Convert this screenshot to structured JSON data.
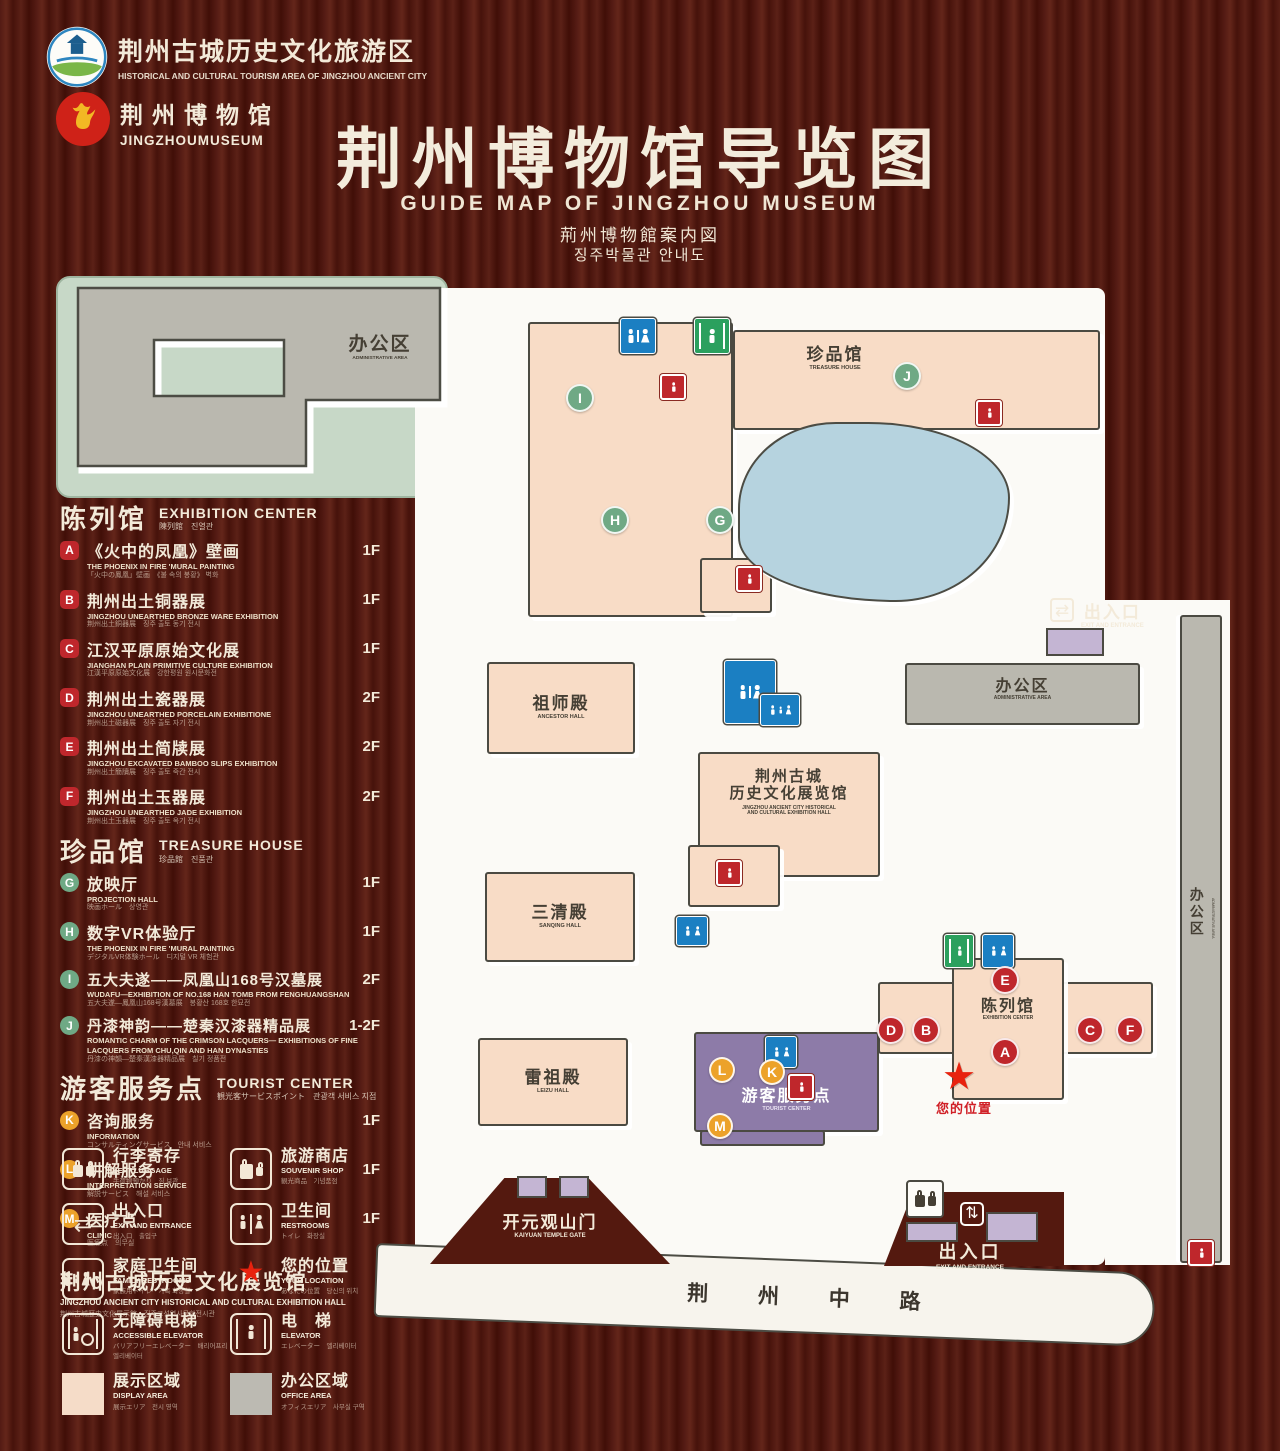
{
  "header": {
    "logo1": {
      "title": "荆州古城历史文化旅游区",
      "subtitle": "HISTORICAL AND CULTURAL TOURISM AREA OF JINGZHOU ANCIENT CITY"
    },
    "logo2": {
      "title": "荆州博物馆",
      "subtitle": "JINGZHOUMUSEUM"
    },
    "title": "荆州博物馆导览图",
    "subtitle_en": "GUIDE MAP OF JINGZHOU MUSEUM",
    "subtitle_ja": "荊州博物館案内図",
    "subtitle_ko": "징주박물관 안내도"
  },
  "legend": {
    "sections": [
      {
        "zh": "陈列馆",
        "en": "EXHIBITION CENTER",
        "sub": "陳列館　진열관",
        "items": [
          {
            "letter": "A",
            "zh": "《火中的凤凰》壁画",
            "en": "THE PHOENIX IN FIRE 'MURAL PAINTING",
            "sub": "「火中の鳳凰」壁画　《불 속의 봉황》 벽화",
            "floor": "1F"
          },
          {
            "letter": "B",
            "zh": "荆州出土铜器展",
            "en": "JINGZHOU UNEARTHED BRONZE WARE EXHIBITION",
            "sub": "荆州出土銅器展　징주 출토 동기 전시",
            "floor": "1F"
          },
          {
            "letter": "C",
            "zh": "江汉平原原始文化展",
            "en": "JIANGHAN PLAIN PRIMITIVE CULTURE EXHIBITION",
            "sub": "江漢平原原始文化展　강한평원 원시문화전",
            "floor": "1F"
          },
          {
            "letter": "D",
            "zh": "荆州出土瓷器展",
            "en": "JINGZHOU UNEARTHED PORCELAIN EXHIBITIONE",
            "sub": "荆州出土磁器展　징주 출토 자기 전시",
            "floor": "2F"
          },
          {
            "letter": "E",
            "zh": "荆州出土简牍展",
            "en": "JINGZHOU EXCAVATED BAMBOO SLIPS EXHIBITION",
            "sub": "荆州出土簡牘展　징주 출토 죽간 전시",
            "floor": "2F"
          },
          {
            "letter": "F",
            "zh": "荆州出土玉器展",
            "en": "JINGZHOU UNEARTHED JADE EXHIBITION",
            "sub": "荆州出土玉器展　징주 출토 옥기 전시",
            "floor": "2F"
          }
        ]
      },
      {
        "zh": "珍品馆",
        "en": "TREASURE HOUSE",
        "sub": "珍品館　진품관",
        "items": [
          {
            "letter": "G",
            "zh": "放映厅",
            "en": "PROJECTION HALL",
            "sub": "映画ホール　상영관",
            "floor": "1F"
          },
          {
            "letter": "H",
            "zh": "数字VR体验厅",
            "en": "THE PHOENIX IN FIRE 'MURAL PAINTING",
            "sub": "デジタルVR体験ホール　디지털 VR 체험관",
            "floor": "1F"
          },
          {
            "letter": "I",
            "zh": "五大夫遂——凤凰山168号汉墓展",
            "en": "WUDAFU—EXHIBITION OF NO.168 HAN TOMB FROM FENGHUANGSHAN",
            "sub": "五大夫遂—鳳凰山168号漢墓展　봉황산 168호 한묘전",
            "floor": "2F"
          },
          {
            "letter": "J",
            "zh": "丹漆神韵——楚秦汉漆器精品展",
            "en": "ROMANTIC CHARM OF THE CRIMSON LACQUERS— EXHIBITIONS OF FINE LACQUERS FROM CHU,QIN AND HAN DYNASTIES",
            "sub": "丹漆の神韻—楚秦漢漆器精品展　칠기 정품전",
            "floor": "1-2F"
          }
        ]
      },
      {
        "zh": "游客服务点",
        "en": "TOURIST CENTER",
        "sub": "観光客サービスポイント　관광객 서비스 지점",
        "items": [
          {
            "letter": "K",
            "zh": "咨询服务",
            "en": "INFORMATION",
            "sub": "コンサルティングサービス　안내 서비스",
            "floor": "1F"
          },
          {
            "letter": "L",
            "zh": "讲解服务",
            "en": "INTERPRETATION SERVICE",
            "sub": "解説サービス　해설 서비스",
            "floor": "1F"
          },
          {
            "letter": "M",
            "zh": "医疗点",
            "en": "CLINIC",
            "sub": "医療点　의무실",
            "floor": "1F"
          }
        ]
      }
    ],
    "hall_note": {
      "zh": "荆州古城历史文化展览馆",
      "en": "JINGZHOU ANCIENT CITY HISTORICAL AND CULTURAL EXHIBITION HALL",
      "sub": "荆州古城歴史文化展示館　징주고성역사문화전시관"
    }
  },
  "facilities": [
    {
      "zh": "行李寄存",
      "en": "LEFT LUGGAGE",
      "sub": "手荷物預かり　짐 보관"
    },
    {
      "zh": "旅游商店",
      "en": "SOUVENIR SHOP",
      "sub": "観光商品　기념품점"
    },
    {
      "zh": "出入口",
      "en": "EXIT AND ENTRANCE",
      "sub": "出入口　출입구"
    },
    {
      "zh": "卫生间",
      "en": "RESTROOMS",
      "sub": "トイレ　화장실"
    },
    {
      "zh": "家庭卫生间",
      "en": "FAMILY RESTROOMS",
      "sub": "家族用トイレ　가족 화장실"
    },
    {
      "zh": "您的位置",
      "en": "YOUR LOCATION",
      "sub": "あなたの位置　당신의 위치"
    },
    {
      "zh": "无障碍电梯",
      "en": "ACCESSIBLE ELEVATOR",
      "sub": "バリアフリーエレベーター　배리어프리 엘리베이터"
    },
    {
      "zh": "电　梯",
      "en": "ELEVATOR",
      "sub": "エレベーター　엘리베이터"
    },
    {
      "zh": "展示区域",
      "en": "DISPLAY AREA",
      "sub": "展示エリア　전시 영역"
    },
    {
      "zh": "办公区域",
      "en": "OFFICE AREA",
      "sub": "オフィスエリア　사무실 구역"
    }
  ],
  "map": {
    "buildings": {
      "admin_top_left": {
        "zh": "办公区",
        "en": "ADMINISTRATIVE AREA"
      },
      "treasure": {
        "zh": "珍品馆",
        "en": "TREASURE HOUSE"
      },
      "ancestor": {
        "zh": "祖师殿",
        "en": "ANCESTOR HALL"
      },
      "sanqing": {
        "zh": "三清殿",
        "en": "SANQING HALL"
      },
      "leizu": {
        "zh": "雷祖殿",
        "en": "LEIZU HALL"
      },
      "exhibition_hall": {
        "zh1": "荆州古城",
        "zh2": "历史文化展览馆",
        "en1": "JINGZHOU ANCIENT CITY HISTORICAL",
        "en2": "AND CULTURAL EXHIBITION HALL"
      },
      "admin_right": {
        "zh": "办公区",
        "en": "ADMINISTRATIVE AREA"
      },
      "admin_strip": {
        "zh": "办公区",
        "en": "ADMINISTRATIVE AREA"
      },
      "tourist": {
        "zh": "游客服务点",
        "en": "TOURIST CENTER"
      },
      "exhibition_center": {
        "zh": "陈列馆",
        "en": "EXHIBITION CENTER"
      },
      "gate_south": {
        "zh": "开元观山门",
        "en": "KAIYUAN TEMPLE GATE"
      }
    },
    "entrance_top": {
      "zh": "出入口",
      "en": "EXIT AND ENTRANCE"
    },
    "entrance_bottom": {
      "zh": "出入口",
      "en": "EXIT AND ENTRANCE"
    },
    "your_location": "您的位置",
    "road": "荆 州 中 路",
    "markers": {
      "A": "A",
      "B": "B",
      "C": "C",
      "D": "D",
      "E": "E",
      "F": "F",
      "G": "G",
      "H": "H",
      "I": "I",
      "J": "J",
      "K": "K",
      "L": "L",
      "M": "M"
    }
  },
  "icons": {
    "star": "★",
    "exit_h": "⇄",
    "exit_v": "⇅"
  },
  "colors": {
    "wood": "#5a1d15",
    "green": "#c7d8c7",
    "pink": "#f8dcc6",
    "gray": "#bab8af",
    "lake": "#b6d3df",
    "purple": "#8d7ba8",
    "blue": "#1b7fc2",
    "red": "#bf272c",
    "marker_green": "#6fa985",
    "orange": "#eca22a"
  }
}
